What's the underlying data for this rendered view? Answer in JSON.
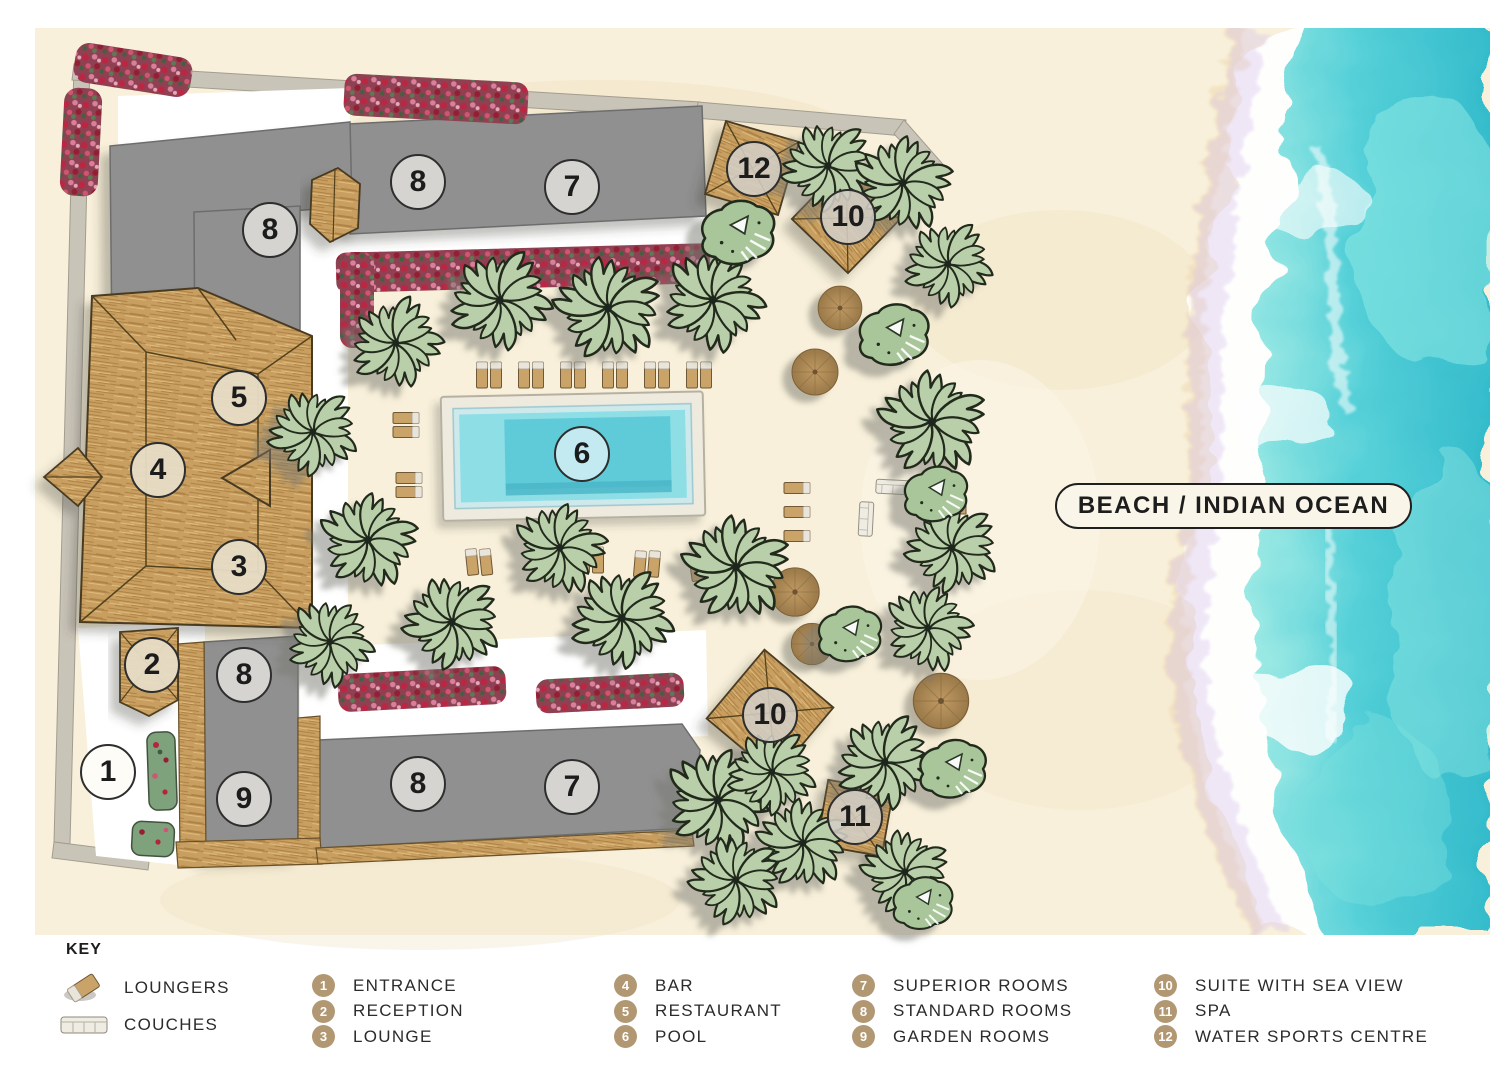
{
  "map": {
    "beach_label": "BEACH / INDIAN OCEAN",
    "markers": [
      {
        "n": "8",
        "x": 268,
        "y": 228,
        "tone": "gray"
      },
      {
        "n": "8",
        "x": 416,
        "y": 180,
        "tone": "gray"
      },
      {
        "n": "7",
        "x": 570,
        "y": 185,
        "tone": "gray"
      },
      {
        "n": "12",
        "x": 752,
        "y": 167,
        "tone": "stone"
      },
      {
        "n": "10",
        "x": 846,
        "y": 215,
        "tone": "stone"
      },
      {
        "n": "5",
        "x": 237,
        "y": 396,
        "tone": "beige"
      },
      {
        "n": "4",
        "x": 156,
        "y": 468,
        "tone": "beige"
      },
      {
        "n": "3",
        "x": 237,
        "y": 565,
        "tone": "beige"
      },
      {
        "n": "6",
        "x": 580,
        "y": 452,
        "tone": "poolblue"
      },
      {
        "n": "2",
        "x": 150,
        "y": 663,
        "tone": "beige"
      },
      {
        "n": "8",
        "x": 242,
        "y": 673,
        "tone": "gray"
      },
      {
        "n": "1",
        "x": 106,
        "y": 770,
        "tone": "white"
      },
      {
        "n": "9",
        "x": 242,
        "y": 797,
        "tone": "gray"
      },
      {
        "n": "8",
        "x": 416,
        "y": 782,
        "tone": "gray"
      },
      {
        "n": "7",
        "x": 570,
        "y": 785,
        "tone": "gray"
      },
      {
        "n": "10",
        "x": 768,
        "y": 713,
        "tone": "stone"
      },
      {
        "n": "11",
        "x": 853,
        "y": 815,
        "tone": "stone"
      }
    ],
    "colors": {
      "sand": "#f8f0da",
      "ocean": "#3fc6d2",
      "foam": "#ffffff",
      "thatch": "#c89f60",
      "building_gray": "#909090",
      "pool_water": "#5fcbd9",
      "palm_green": "#b9cfa9",
      "flower_red": "#bb2742",
      "accent_tan": "#b29872"
    }
  },
  "key": {
    "title": "KEY",
    "accent_color": "#b29872",
    "symbols": [
      {
        "icon": "lounger-icon",
        "label": "LOUNGERS"
      },
      {
        "icon": "couch-icon",
        "label": "COUCHES"
      }
    ],
    "columns": [
      [
        {
          "n": "1",
          "label": "ENTRANCE"
        },
        {
          "n": "2",
          "label": "RECEPTION"
        },
        {
          "n": "3",
          "label": "LOUNGE"
        }
      ],
      [
        {
          "n": "4",
          "label": "BAR"
        },
        {
          "n": "5",
          "label": "RESTAURANT"
        },
        {
          "n": "6",
          "label": "POOL"
        }
      ],
      [
        {
          "n": "7",
          "label": "SUPERIOR ROOMS"
        },
        {
          "n": "8",
          "label": "STANDARD ROOMS"
        },
        {
          "n": "9",
          "label": "GARDEN ROOMS"
        }
      ],
      [
        {
          "n": "10",
          "label": "SUITE WITH SEA VIEW"
        },
        {
          "n": "11",
          "label": "SPA"
        },
        {
          "n": "12",
          "label": "WATER SPORTS CENTRE"
        }
      ]
    ]
  }
}
